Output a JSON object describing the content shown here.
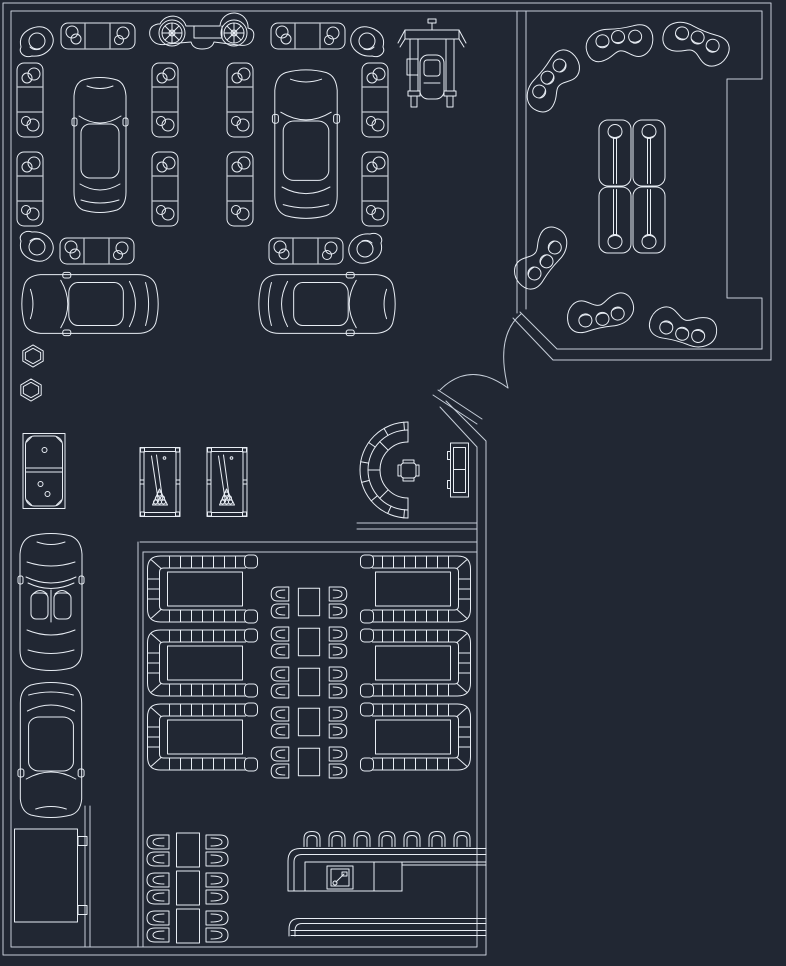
{
  "meta": {
    "drawing": "car-showroom-lounge-cafe-floor-plan",
    "colors": {
      "background": "#212733",
      "line": "#e8edf4",
      "wall": "#c6ced9"
    }
  },
  "canvas": {
    "width": 786,
    "height": 966
  },
  "walls": {
    "polylines": [
      [
        [
          771,
          360
        ],
        [
          771,
          3
        ],
        [
          3,
          3
        ],
        [
          3,
          955
        ],
        [
          486,
          955
        ],
        [
          486,
          441
        ],
        [
          446,
          401
        ]
      ],
      [
        [
          771,
          360
        ],
        [
          553,
          360
        ],
        [
          513,
          318
        ]
      ],
      [
        [
          762,
          349
        ],
        [
          762,
          298
        ],
        [
          727,
          298
        ],
        [
          727,
          79
        ],
        [
          762,
          79
        ],
        [
          762,
          11
        ],
        [
          11,
          11
        ],
        [
          11,
          947
        ],
        [
          477,
          947
        ],
        [
          477,
          447
        ],
        [
          440,
          407
        ]
      ],
      [
        [
          762,
          349
        ],
        [
          557,
          349
        ],
        [
          520,
          312
        ]
      ],
      [
        [
          517,
          11
        ],
        [
          517,
          313
        ]
      ],
      [
        [
          526,
          11
        ],
        [
          526,
          309
        ]
      ],
      [
        [
          140,
          542
        ],
        [
          477,
          542
        ]
      ],
      [
        [
          143,
          552
        ],
        [
          477,
          552
        ]
      ],
      [
        [
          138,
          542
        ],
        [
          138,
          947
        ]
      ],
      [
        [
          143,
          552
        ],
        [
          143,
          947
        ]
      ],
      [
        [
          85,
          806
        ],
        [
          85,
          947
        ]
      ],
      [
        [
          90,
          806
        ],
        [
          90,
          947
        ]
      ],
      [
        [
          357,
          523
        ],
        [
          477,
          523
        ]
      ],
      [
        [
          357,
          529
        ],
        [
          477,
          529
        ]
      ],
      [
        [
          438,
          390
        ],
        [
          482,
          419
        ]
      ],
      [
        [
          433,
          395
        ],
        [
          477,
          424
        ]
      ]
    ],
    "arcs": [
      "M521,314 Q495,336 508,388",
      "M440,390 Q470,360 508,388"
    ]
  },
  "objects": [
    {
      "t": "sofa-h",
      "n": "sofa-3seat",
      "x": 98,
      "y": 36
    },
    {
      "t": "sofa-h",
      "n": "sofa-3seat",
      "x": 308,
      "y": 36
    },
    {
      "t": "sofa-h",
      "n": "sofa-3seat",
      "x": 97,
      "y": 251
    },
    {
      "t": "sofa-h",
      "n": "sofa-3seat",
      "x": 306,
      "y": 251
    },
    {
      "t": "sofa-h",
      "n": "sofa-3seat-vertical",
      "x": 30,
      "y": 100,
      "r": 90
    },
    {
      "t": "sofa-h",
      "n": "sofa-3seat-vertical",
      "x": 30,
      "y": 189,
      "r": 90
    },
    {
      "t": "sofa-h",
      "n": "sofa-3seat-vertical",
      "x": 165,
      "y": 100,
      "r": 90
    },
    {
      "t": "sofa-h",
      "n": "sofa-3seat-vertical",
      "x": 165,
      "y": 189,
      "r": 90
    },
    {
      "t": "sofa-h",
      "n": "sofa-3seat-vertical",
      "x": 240,
      "y": 100,
      "r": 90
    },
    {
      "t": "sofa-h",
      "n": "sofa-3seat-vertical",
      "x": 240,
      "y": 189,
      "r": 90
    },
    {
      "t": "sofa-h",
      "n": "sofa-3seat-vertical",
      "x": 375,
      "y": 100,
      "r": 90
    },
    {
      "t": "sofa-h",
      "n": "sofa-3seat-vertical",
      "x": 375,
      "y": 189,
      "r": 90
    },
    {
      "t": "armchair",
      "n": "corner-armchair",
      "x": 36,
      "y": 40
    },
    {
      "t": "armchair",
      "n": "corner-armchair",
      "x": 368,
      "y": 40,
      "sx": -1
    },
    {
      "t": "armchair",
      "n": "corner-armchair",
      "x": 36,
      "y": 248,
      "sy": -1
    },
    {
      "t": "armchair",
      "n": "corner-armchair",
      "x": 366,
      "y": 250,
      "sx": -1,
      "sy": -1
    },
    {
      "t": "car-side",
      "n": "classic-car-side-view",
      "x": 202,
      "y": 35
    },
    {
      "t": "car-lift",
      "n": "car-on-service-lift",
      "x": 432,
      "y": 63
    },
    {
      "t": "car-top",
      "n": "coupe-car-top-view",
      "x": 100,
      "y": 144
    },
    {
      "t": "car-top",
      "n": "coupe-car-top-view",
      "x": 306,
      "y": 143,
      "sx": 1.2,
      "sy": 1.1
    },
    {
      "t": "car-top",
      "n": "coupe-car-top-view",
      "x": 89,
      "y": 304,
      "r": -90,
      "sx": 1.13,
      "sy": 1.01
    },
    {
      "t": "car-top",
      "n": "coupe-car-top-view",
      "x": 328,
      "y": 304,
      "r": 90,
      "sx": 1.13,
      "sy": 1.01
    },
    {
      "t": "car-open",
      "n": "convertible-car-top-view",
      "x": 51,
      "y": 601
    },
    {
      "t": "car-top",
      "n": "coupe-car-top-view",
      "x": 51,
      "y": 751,
      "r": 180,
      "sx": 1.18
    },
    {
      "t": "hexagon",
      "n": "hexagonal-side-table",
      "x": 33,
      "y": 356,
      "sx": 0.85,
      "sy": 0.85
    },
    {
      "t": "hexagon",
      "n": "hexagonal-side-table",
      "x": 31,
      "y": 390,
      "sx": 0.85,
      "sy": 0.85
    },
    {
      "t": "domino",
      "n": "domino-game-table",
      "x": 44,
      "y": 471
    },
    {
      "t": "pool",
      "n": "billiard-table",
      "x": 160,
      "y": 482
    },
    {
      "t": "pool",
      "n": "billiard-table",
      "x": 227,
      "y": 482
    },
    {
      "t": "reception",
      "n": "semicircular-reception-desk",
      "x": 408,
      "y": 470
    },
    {
      "t": "cabinet",
      "n": "reception-cabinet",
      "x": 458,
      "y": 470
    },
    {
      "t": "bean",
      "n": "curved-lounge-sofa",
      "x": 553,
      "y": 82,
      "r": -52
    },
    {
      "t": "bean",
      "n": "curved-lounge-sofa",
      "x": 619,
      "y": 44,
      "r": -8
    },
    {
      "t": "bean",
      "n": "curved-lounge-sofa",
      "x": 695,
      "y": 44,
      "r": 22
    },
    {
      "t": "bean",
      "n": "curved-lounge-sofa",
      "x": 541,
      "y": 257,
      "r": 128
    },
    {
      "t": "bean",
      "n": "curved-lounge-sofa",
      "x": 601,
      "y": 312,
      "r": 168
    },
    {
      "t": "bean",
      "n": "curved-lounge-sofa",
      "x": 684,
      "y": 327,
      "r": 195
    },
    {
      "t": "lounge-table",
      "n": "planter-table-unit",
      "x": 632,
      "y": 153
    },
    {
      "t": "lounge-table",
      "n": "planter-table-unit",
      "x": 632,
      "y": 220,
      "r": 180
    },
    {
      "t": "booth",
      "n": "booth-seating-with-table",
      "x": 202,
      "y": 589
    },
    {
      "t": "booth",
      "n": "booth-seating-with-table",
      "x": 202,
      "y": 663
    },
    {
      "t": "booth",
      "n": "booth-seating-with-table",
      "x": 202,
      "y": 737
    },
    {
      "t": "booth",
      "n": "booth-seating-with-table",
      "x": 416,
      "y": 589,
      "sx": -1
    },
    {
      "t": "booth",
      "n": "booth-seating-with-table",
      "x": 416,
      "y": 663,
      "sx": -1
    },
    {
      "t": "booth",
      "n": "booth-seating-with-table",
      "x": 416,
      "y": 737,
      "sx": -1
    },
    {
      "t": "table-s",
      "n": "dining-table",
      "x": 309,
      "y": 602,
      "sx": 0.85,
      "sy": 0.95
    },
    {
      "t": "table-s",
      "n": "dining-table",
      "x": 309,
      "y": 642,
      "sx": 0.85,
      "sy": 0.95
    },
    {
      "t": "table-s",
      "n": "dining-table",
      "x": 309,
      "y": 682,
      "sx": 0.85,
      "sy": 0.95
    },
    {
      "t": "table-s",
      "n": "dining-table",
      "x": 309,
      "y": 722,
      "sx": 0.85,
      "sy": 0.95
    },
    {
      "t": "table-s",
      "n": "dining-table",
      "x": 309,
      "y": 762,
      "sx": 0.85,
      "sy": 0.95
    },
    {
      "t": "chairs",
      "n": "chair-pair",
      "x": 280,
      "y": 602,
      "sx": 0.8
    },
    {
      "t": "chairs",
      "n": "chair-pair",
      "x": 280,
      "y": 642,
      "sx": 0.8
    },
    {
      "t": "chairs",
      "n": "chair-pair",
      "x": 280,
      "y": 682,
      "sx": 0.8
    },
    {
      "t": "chairs",
      "n": "chair-pair",
      "x": 280,
      "y": 722,
      "sx": 0.8
    },
    {
      "t": "chairs",
      "n": "chair-pair",
      "x": 280,
      "y": 762,
      "sx": 0.8
    },
    {
      "t": "chairs",
      "n": "chair-pair",
      "x": 338,
      "y": 602,
      "sx": -0.8
    },
    {
      "t": "chairs",
      "n": "chair-pair",
      "x": 338,
      "y": 642,
      "sx": -0.8
    },
    {
      "t": "chairs",
      "n": "chair-pair",
      "x": 338,
      "y": 682,
      "sx": -0.8
    },
    {
      "t": "chairs",
      "n": "chair-pair",
      "x": 338,
      "y": 722,
      "sx": -0.8
    },
    {
      "t": "chairs",
      "n": "chair-pair",
      "x": 338,
      "y": 762,
      "sx": -0.8
    },
    {
      "t": "table-s",
      "n": "dining-table",
      "x": 188,
      "y": 850,
      "sx": 0.92,
      "sy": 1.17
    },
    {
      "t": "table-s",
      "n": "dining-table",
      "x": 188,
      "y": 888,
      "sx": 0.92,
      "sy": 1.17
    },
    {
      "t": "table-s",
      "n": "dining-table",
      "x": 188,
      "y": 926,
      "sx": 0.92,
      "sy": 1.17
    },
    {
      "t": "chairs",
      "n": "chair-pair",
      "x": 158,
      "y": 850
    },
    {
      "t": "chairs",
      "n": "chair-pair",
      "x": 158,
      "y": 888
    },
    {
      "t": "chairs",
      "n": "chair-pair",
      "x": 158,
      "y": 926
    },
    {
      "t": "chairs",
      "n": "chair-pair",
      "x": 217,
      "y": 850,
      "sx": -1
    },
    {
      "t": "chairs",
      "n": "chair-pair",
      "x": 217,
      "y": 888,
      "sx": -1
    },
    {
      "t": "chairs",
      "n": "chair-pair",
      "x": 217,
      "y": 926,
      "sx": -1
    },
    {
      "t": "stool",
      "n": "bar-stool",
      "x": 312,
      "y": 838
    },
    {
      "t": "stool",
      "n": "bar-stool",
      "x": 337,
      "y": 838
    },
    {
      "t": "stool",
      "n": "bar-stool",
      "x": 362,
      "y": 838
    },
    {
      "t": "stool",
      "n": "bar-stool",
      "x": 387,
      "y": 838
    },
    {
      "t": "stool",
      "n": "bar-stool",
      "x": 412,
      "y": 838
    },
    {
      "t": "stool",
      "n": "bar-stool",
      "x": 437,
      "y": 838
    },
    {
      "t": "stool",
      "n": "bar-stool",
      "x": 462,
      "y": 838
    },
    {
      "t": "bar-top",
      "n": "bar-counter-with-sink",
      "x": 387,
      "y": 871
    },
    {
      "t": "bar-back",
      "n": "back-bar-counter",
      "x": 387,
      "y": 927
    },
    {
      "t": "closet",
      "n": "storage-closet",
      "x": 51,
      "y": 876
    }
  ]
}
